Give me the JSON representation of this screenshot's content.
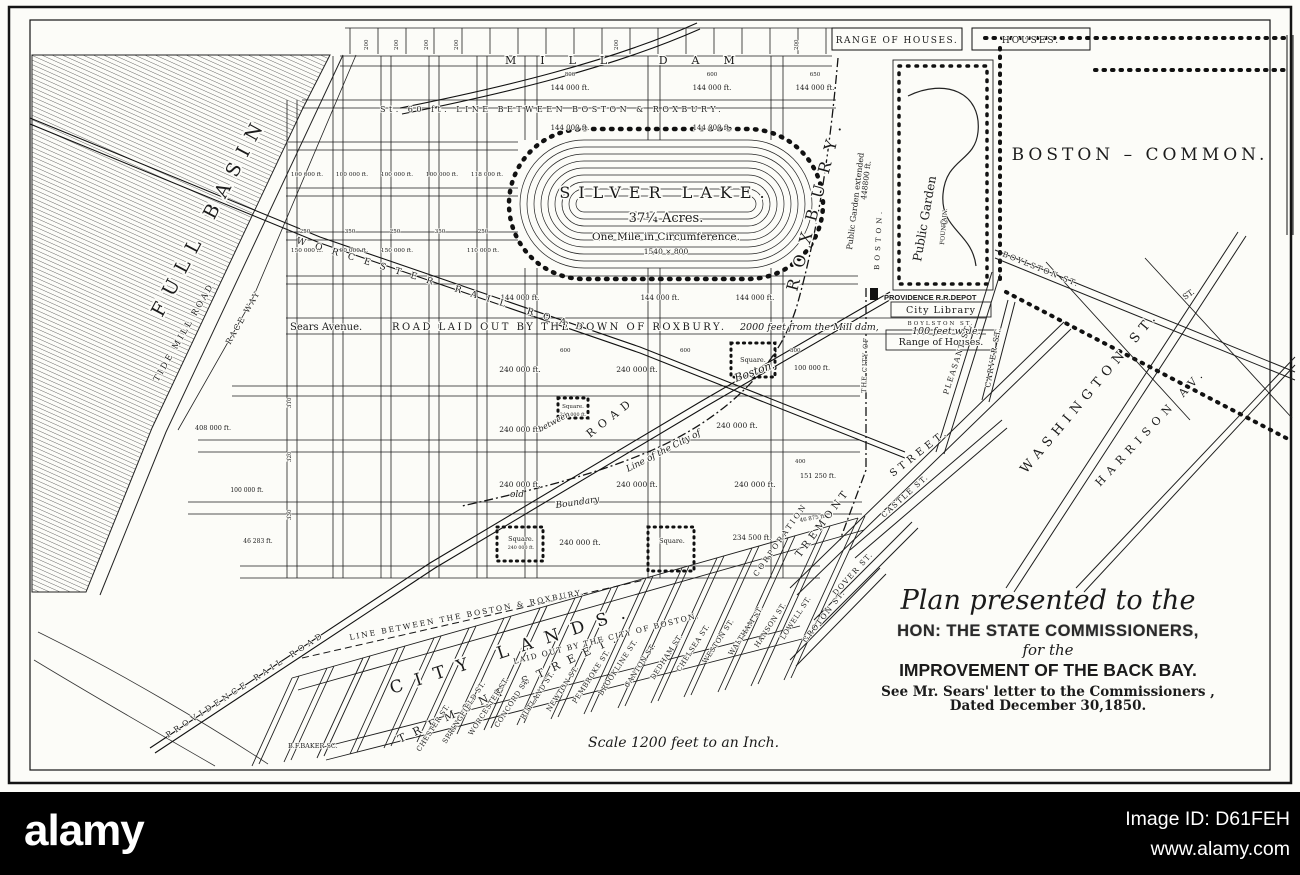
{
  "footer": {
    "brand": "alamy",
    "image_id": "Image ID: D61FEH",
    "url": "www.alamy.com"
  },
  "title_block": {
    "line1": "Plan presented to the",
    "line2": "HON: THE STATE COMMISSIONERS,",
    "line3": "for the",
    "line4": "IMPROVEMENT OF THE BACK BAY.",
    "line5": "See Mr. Sears' letter to the Commissioners ,",
    "line6": "Dated December 30,1850."
  },
  "map": {
    "labels": [
      {
        "n": "label-range-of-houses",
        "t": "RANGE OF HOUSES.",
        "x": 897,
        "y": 43,
        "s": 9,
        "ls": 1.5,
        "a": "middle"
      },
      {
        "n": "label-houses",
        "t": "HOUSES.",
        "x": 1031,
        "y": 43,
        "s": 9,
        "ls": 2,
        "a": "middle"
      },
      {
        "n": "label-mill-dam",
        "t": "MILL DAM",
        "x": 505,
        "y": 64,
        "s": 11,
        "ls": 24
      },
      {
        "n": "label-st60-line",
        "t": "St. 60 ft. LINE BETWEEN BOSTON & ROXBURY.",
        "x": 380,
        "y": 112,
        "s": 8,
        "ls": 3.5
      },
      {
        "t": "200",
        "x": 368,
        "y": 50,
        "r": -90,
        "s": 5.5
      },
      {
        "t": "200",
        "x": 398,
        "y": 50,
        "r": -90,
        "s": 5.5
      },
      {
        "t": "200",
        "x": 428,
        "y": 50,
        "r": -90,
        "s": 5.5
      },
      {
        "t": "200",
        "x": 458,
        "y": 50,
        "r": -90,
        "s": 5.5
      },
      {
        "t": "200",
        "x": 618,
        "y": 50,
        "r": -90,
        "s": 5.5
      },
      {
        "t": "200",
        "x": 798,
        "y": 50,
        "r": -90,
        "s": 5.5
      },
      {
        "t": "800",
        "x": 570,
        "y": 76,
        "s": 5.5,
        "a": "middle"
      },
      {
        "t": "600",
        "x": 712,
        "y": 76,
        "s": 5.5,
        "a": "middle"
      },
      {
        "t": "650",
        "x": 815,
        "y": 76,
        "s": 5.5,
        "a": "middle"
      },
      {
        "t": "144 000 ft.",
        "x": 570,
        "y": 90,
        "s": 7,
        "a": "middle"
      },
      {
        "t": "144 000 ft.",
        "x": 712,
        "y": 90,
        "s": 7,
        "a": "middle"
      },
      {
        "t": "144 000 ft.",
        "x": 815,
        "y": 90,
        "s": 7,
        "a": "middle"
      },
      {
        "t": "144 000 ft.",
        "x": 570,
        "y": 130,
        "s": 7,
        "a": "middle"
      },
      {
        "t": "144 000 ft.",
        "x": 712,
        "y": 130,
        "s": 7,
        "a": "middle"
      },
      {
        "n": "silver-lake-name",
        "t": "SILVER LAKE.",
        "x": 666,
        "y": 198,
        "s": 16,
        "ls": 8,
        "a": "middle"
      },
      {
        "n": "silver-lake-acres",
        "t": "37¼ Acres.",
        "x": 666,
        "y": 222,
        "s": 13,
        "a": "middle"
      },
      {
        "n": "silver-lake-circumference",
        "t": "One Mile in Circumference.",
        "x": 666,
        "y": 240,
        "s": 10.5,
        "a": "middle"
      },
      {
        "n": "silver-lake-dimensions",
        "t": "1540 × 800",
        "x": 666,
        "y": 254,
        "s": 7.5,
        "a": "middle"
      },
      {
        "t": "100 000 ft.",
        "x": 307,
        "y": 176,
        "s": 5.8,
        "a": "middle"
      },
      {
        "t": "100 000 ft.",
        "x": 352,
        "y": 176,
        "s": 5.8,
        "a": "middle"
      },
      {
        "t": "100 000 ft.",
        "x": 397,
        "y": 176,
        "s": 5.8,
        "a": "middle"
      },
      {
        "t": "100 000 ft.",
        "x": 442,
        "y": 176,
        "s": 5.8,
        "a": "middle"
      },
      {
        "t": "118 000 ft.",
        "x": 487,
        "y": 176,
        "s": 5.8,
        "a": "middle"
      },
      {
        "t": "250",
        "x": 305,
        "y": 233,
        "s": 5.5,
        "a": "middle"
      },
      {
        "t": "350",
        "x": 350,
        "y": 233,
        "s": 5.5,
        "a": "middle"
      },
      {
        "t": "250",
        "x": 395,
        "y": 233,
        "s": 5.5,
        "a": "middle"
      },
      {
        "t": "350",
        "x": 440,
        "y": 233,
        "s": 5.5,
        "a": "middle"
      },
      {
        "t": "250",
        "x": 483,
        "y": 233,
        "s": 5.5,
        "a": "middle"
      },
      {
        "t": "150 000 ft.",
        "x": 307,
        "y": 252,
        "s": 5.8,
        "a": "middle"
      },
      {
        "t": "100 000 ft.",
        "x": 352,
        "y": 252,
        "s": 5.8,
        "a": "middle"
      },
      {
        "t": "150 000 ft.",
        "x": 397,
        "y": 252,
        "s": 5.8,
        "a": "middle"
      },
      {
        "t": "110 000 ft.",
        "x": 483,
        "y": 252,
        "s": 5.8,
        "a": "middle"
      },
      {
        "t": "144 000 ft.",
        "x": 520,
        "y": 300,
        "s": 7,
        "a": "middle"
      },
      {
        "t": "144 000 ft.",
        "x": 660,
        "y": 300,
        "s": 7,
        "a": "middle"
      },
      {
        "t": "144 000 ft.",
        "x": 755,
        "y": 300,
        "s": 7,
        "a": "middle"
      },
      {
        "n": "label-sears-avenue",
        "t": "Sears Avenue.",
        "x": 290,
        "y": 330,
        "s": 10
      },
      {
        "n": "label-road-laid-out",
        "t": "ROAD LAID OUT BY THE TOWN OF ROXBURY.",
        "x": 392,
        "y": 330,
        "s": 10,
        "ls": 2.5
      },
      {
        "t": "2000 feet from the Mill dam,",
        "x": 740,
        "y": 330,
        "s": 9.5,
        "it": 1
      },
      {
        "t": "100 feet wide.",
        "x": 912,
        "y": 334,
        "s": 9.5,
        "it": 1
      },
      {
        "t": "600",
        "x": 560,
        "y": 352,
        "s": 5.5
      },
      {
        "t": "600",
        "x": 680,
        "y": 352,
        "s": 5.5
      },
      {
        "t": "800",
        "x": 790,
        "y": 352,
        "s": 5.5
      },
      {
        "t": "240 000 ft.",
        "x": 520,
        "y": 372,
        "s": 7.5,
        "a": "middle"
      },
      {
        "t": "240 000 ft.",
        "x": 637,
        "y": 372,
        "s": 7.5,
        "a": "middle"
      },
      {
        "t": "100 000 ft.",
        "x": 812,
        "y": 370,
        "s": 6.5,
        "a": "middle"
      },
      {
        "n": "label-square-1",
        "t": "Square.",
        "x": 753,
        "y": 362,
        "s": 6.5,
        "a": "middle"
      },
      {
        "t": "408 000 ft.",
        "x": 213,
        "y": 430,
        "s": 6.5,
        "a": "middle"
      },
      {
        "t": "240 000 ft.",
        "x": 520,
        "y": 432,
        "s": 7.5,
        "a": "middle"
      },
      {
        "t": "240 000 ft.",
        "x": 737,
        "y": 428,
        "s": 7.5,
        "a": "middle"
      },
      {
        "n": "label-square-small",
        "t": "Square.",
        "x": 573,
        "y": 408,
        "s": 5.5,
        "a": "middle"
      },
      {
        "t": "240 000 ft.",
        "x": 573,
        "y": 416,
        "s": 4.8,
        "a": "middle"
      },
      {
        "n": "label-road-diag",
        "t": "ROAD",
        "x": 590,
        "y": 438,
        "r": -38,
        "s": 11,
        "ls": 6
      },
      {
        "t": "between",
        "x": 540,
        "y": 432,
        "r": -28,
        "s": 8,
        "it": 1
      },
      {
        "n": "label-boston-script",
        "t": "Boston.",
        "x": 736,
        "y": 382,
        "r": -20,
        "s": 11,
        "it": 1
      },
      {
        "t": "old",
        "x": 510,
        "y": 497,
        "s": 9,
        "it": 1
      },
      {
        "t": "Boundary",
        "x": 556,
        "y": 508,
        "r": -8,
        "s": 9,
        "it": 1
      },
      {
        "t": "Line of the City of",
        "x": 628,
        "y": 472,
        "r": -27,
        "s": 9,
        "it": 1
      },
      {
        "t": "240 000 ft.",
        "x": 520,
        "y": 487,
        "s": 7.5,
        "a": "middle"
      },
      {
        "t": "240 000 ft.",
        "x": 637,
        "y": 487,
        "s": 7.5,
        "a": "middle"
      },
      {
        "t": "240 000 ft.",
        "x": 755,
        "y": 487,
        "s": 7.5,
        "a": "middle"
      },
      {
        "t": "151 250 ft.",
        "x": 818,
        "y": 478,
        "s": 6.5,
        "a": "middle"
      },
      {
        "t": "100 000 ft.",
        "x": 247,
        "y": 492,
        "s": 6,
        "a": "middle"
      },
      {
        "t": "400",
        "x": 795,
        "y": 463,
        "s": 5.5
      },
      {
        "t": "46 875 ft.",
        "x": 800,
        "y": 522,
        "r": -10,
        "s": 5.5
      },
      {
        "t": "46 283 ft.",
        "x": 258,
        "y": 543,
        "s": 6,
        "a": "middle"
      },
      {
        "t": "240 000 ft.",
        "x": 580,
        "y": 545,
        "s": 7.5,
        "a": "middle"
      },
      {
        "t": "234 500 ft.",
        "x": 752,
        "y": 540,
        "s": 7,
        "a": "middle"
      },
      {
        "n": "label-square-2",
        "t": "Square.",
        "x": 521,
        "y": 541,
        "s": 6.5,
        "a": "middle"
      },
      {
        "t": "240 000 ft.",
        "x": 521,
        "y": 549,
        "s": 4.8,
        "a": "middle"
      },
      {
        "n": "label-square-3",
        "t": "Square.",
        "x": 672,
        "y": 543,
        "s": 6.5,
        "a": "middle"
      },
      {
        "t": "310",
        "x": 291,
        "y": 408,
        "r": -90,
        "s": 5.5
      },
      {
        "t": "320",
        "x": 291,
        "y": 462,
        "r": -90,
        "s": 5.5
      },
      {
        "t": "330",
        "x": 291,
        "y": 520,
        "r": -90,
        "s": 5.5
      },
      {
        "n": "label-full-basin",
        "t": "FULL BASIN",
        "x": 162,
        "y": 318,
        "r": -62,
        "s": 19,
        "ls": 10
      },
      {
        "n": "label-tide-mill-road",
        "t": "TIDE MILL ROAD.",
        "x": 158,
        "y": 382,
        "r": -60,
        "s": 8.5,
        "ls": 2.5
      },
      {
        "n": "label-race-way",
        "t": "RACE WAY",
        "x": 230,
        "y": 345,
        "r": -60,
        "s": 8,
        "ls": 2
      },
      {
        "n": "label-worcester-rr",
        "t": "WORCESTER RAIL ROAD",
        "x": 296,
        "y": 243,
        "r": 17,
        "s": 9,
        "ls": 10
      },
      {
        "n": "label-providence-rr",
        "t": "PROVIDENCE RAIL ROAD",
        "x": 168,
        "y": 738,
        "r": -33,
        "s": 8,
        "ls": 4
      },
      {
        "n": "label-providence-depot",
        "t": "PROVIDENCE R.R.DEPOT",
        "x": 884,
        "y": 300,
        "s": 7.5,
        "b": 1,
        "ff": "sans"
      },
      {
        "n": "label-roxbury-big",
        "t": "ROXBURY.",
        "x": 797,
        "y": 292,
        "r": -75,
        "s": 16,
        "ls": 12
      },
      {
        "n": "label-boston-small",
        "t": "BOSTON.",
        "x": 879,
        "y": 270,
        "r": -87,
        "s": 7,
        "ls": 4
      },
      {
        "n": "label-city-of",
        "t": "THE CITY OF",
        "x": 866,
        "y": 393,
        "r": -88,
        "s": 6.5,
        "ls": 1
      },
      {
        "n": "label-public-garden-ext",
        "t": "Public Garden extended",
        "x": 852,
        "y": 250,
        "r": -83,
        "s": 8
      },
      {
        "t": "448800 ft.",
        "x": 866,
        "y": 200,
        "r": -83,
        "s": 7.5
      },
      {
        "n": "label-public-garden",
        "t": "Public Garden",
        "x": 921,
        "y": 262,
        "r": -80,
        "s": 12
      },
      {
        "n": "label-fountain",
        "t": "FOUNTAIN.",
        "x": 944,
        "y": 245,
        "r": -85,
        "s": 6
      },
      {
        "n": "label-city-library",
        "t": "City Library",
        "x": 941,
        "y": 313,
        "s": 9.5,
        "ls": 1,
        "a": "middle"
      },
      {
        "n": "label-boylston-small",
        "t": "BOYLSTON ST.",
        "x": 941,
        "y": 325,
        "s": 5.5,
        "ls": 2,
        "a": "middle"
      },
      {
        "n": "label-range-houses-2",
        "t": "Range of Houses.",
        "x": 941,
        "y": 345,
        "s": 9.5,
        "a": "middle"
      },
      {
        "n": "label-boston-common",
        "t": "BOSTON – COMMON.",
        "x": 1140,
        "y": 160,
        "s": 17,
        "ls": 4,
        "a": "middle"
      },
      {
        "n": "label-boylston-diag",
        "t": "BOYLSTON ST.",
        "x": 1002,
        "y": 256,
        "r": 22,
        "s": 7.5,
        "ls": 2
      },
      {
        "t": "ST.",
        "x": 1185,
        "y": 300,
        "r": -35,
        "s": 8
      },
      {
        "n": "label-washington",
        "t": "WASHINGTON ST.",
        "x": 1026,
        "y": 474,
        "r": -50,
        "s": 13,
        "ls": 6
      },
      {
        "n": "label-harrison",
        "t": "HARRISON AV.",
        "x": 1100,
        "y": 487,
        "r": -47,
        "s": 11,
        "ls": 6
      },
      {
        "n": "label-pleasant",
        "t": "PLEASANT ST.",
        "x": 948,
        "y": 395,
        "r": -72,
        "s": 7.5,
        "ls": 1.5
      },
      {
        "n": "label-carver",
        "t": "CARVER ST.",
        "x": 990,
        "y": 388,
        "r": -80,
        "s": 7.5,
        "ls": 1.5
      },
      {
        "n": "label-castle",
        "t": "CASTLE ST.",
        "x": 884,
        "y": 518,
        "r": -42,
        "s": 7.5,
        "ls": 1.5
      },
      {
        "n": "label-tremont-mid",
        "t": "TREMONT",
        "x": 800,
        "y": 558,
        "r": -53,
        "s": 10,
        "ls": 4
      },
      {
        "n": "label-street-mid",
        "t": "STREET.",
        "x": 893,
        "y": 477,
        "r": -38,
        "s": 10,
        "ls": 4
      },
      {
        "n": "label-corporation",
        "t": "CORPORATION",
        "x": 757,
        "y": 577,
        "r": -55,
        "s": 7.5,
        "ls": 2.5
      },
      {
        "n": "label-dover",
        "t": "DOVER ST.",
        "x": 836,
        "y": 596,
        "r": -48,
        "s": 7.5,
        "ls": 1.5
      },
      {
        "n": "label-groton",
        "t": "GROTON ST.",
        "x": 806,
        "y": 643,
        "r": -52,
        "s": 7.5,
        "ls": 1.5
      },
      {
        "n": "label-city-lands",
        "t": "CITY LANDS.",
        "x": 392,
        "y": 694,
        "r": -18,
        "s": 17,
        "ls": 13
      },
      {
        "n": "label-tremont-big",
        "t": "TREMONT STREET.",
        "x": 400,
        "y": 743,
        "r": -25,
        "s": 11,
        "ls": 9
      },
      {
        "n": "label-line-between-bottom",
        "t": "LINE BETWEEN THE BOSTON & ROXBURY.",
        "x": 350,
        "y": 640,
        "r": -11,
        "s": 7.5,
        "ls": 2
      },
      {
        "n": "label-laid-out-city",
        "t": "LAID OUT BY THE CITY OF BOSTON.",
        "x": 514,
        "y": 664,
        "r": -14,
        "s": 7.5,
        "ls": 1.5
      },
      {
        "n": "street-chester",
        "t": "CHESTER ST.",
        "x": 420,
        "y": 752,
        "r": -57,
        "s": 7,
        "ls": 0.5
      },
      {
        "n": "street-springfield",
        "t": "SPRINGFIELD ST.",
        "x": 446,
        "y": 744,
        "r": -57,
        "s": 7,
        "ls": 0.5
      },
      {
        "n": "street-worcester",
        "t": "WORCESTER ST.",
        "x": 472,
        "y": 736,
        "r": -57,
        "s": 7,
        "ls": 0.5
      },
      {
        "n": "street-concord",
        "t": "CONCORD ST.",
        "x": 498,
        "y": 728,
        "r": -57,
        "s": 7,
        "ls": 0.5
      },
      {
        "n": "street-rutland",
        "t": "RUTLAND ST.",
        "x": 524,
        "y": 720,
        "r": -57,
        "s": 7,
        "ls": 0.5
      },
      {
        "n": "street-newton",
        "t": "NEWTON ST.",
        "x": 550,
        "y": 712,
        "r": -57,
        "s": 7,
        "ls": 0.5
      },
      {
        "n": "street-pembroke",
        "t": "PEMBROKE ST.",
        "x": 576,
        "y": 704,
        "r": -57,
        "s": 7,
        "ls": 0.5
      },
      {
        "n": "street-brookline",
        "t": "BROOKLINE ST.",
        "x": 602,
        "y": 696,
        "r": -57,
        "s": 7,
        "ls": 0.5
      },
      {
        "n": "street-canton",
        "t": "CANTON ST.",
        "x": 628,
        "y": 688,
        "r": -57,
        "s": 7,
        "ls": 0.5
      },
      {
        "n": "street-dedham",
        "t": "DEDHAM ST.",
        "x": 654,
        "y": 680,
        "r": -57,
        "s": 7,
        "ls": 0.5
      },
      {
        "n": "street-chelsea",
        "t": "CHELSEA ST.",
        "x": 680,
        "y": 672,
        "r": -57,
        "s": 7,
        "ls": 0.5
      },
      {
        "n": "street-weston",
        "t": "WESTON ST.",
        "x": 706,
        "y": 664,
        "r": -57,
        "s": 7,
        "ls": 0.5
      },
      {
        "n": "street-waltham",
        "t": "WALTHAM ST.",
        "x": 732,
        "y": 656,
        "r": -57,
        "s": 7,
        "ls": 0.5
      },
      {
        "n": "street-hanson",
        "t": "HANSON ST.",
        "x": 758,
        "y": 648,
        "r": -57,
        "s": 7,
        "ls": 0.5
      },
      {
        "n": "street-lowell",
        "t": "LOWELL ST.",
        "x": 784,
        "y": 640,
        "r": -57,
        "s": 7,
        "ls": 0.5
      },
      {
        "n": "label-scale",
        "t": "Scale 1200 feet to an Inch.",
        "x": 588,
        "y": 747,
        "s": 14,
        "it": 1
      },
      {
        "n": "label-engraver",
        "t": "B.F.BAKER SC.",
        "x": 288,
        "y": 748,
        "s": 6.5
      }
    ]
  }
}
